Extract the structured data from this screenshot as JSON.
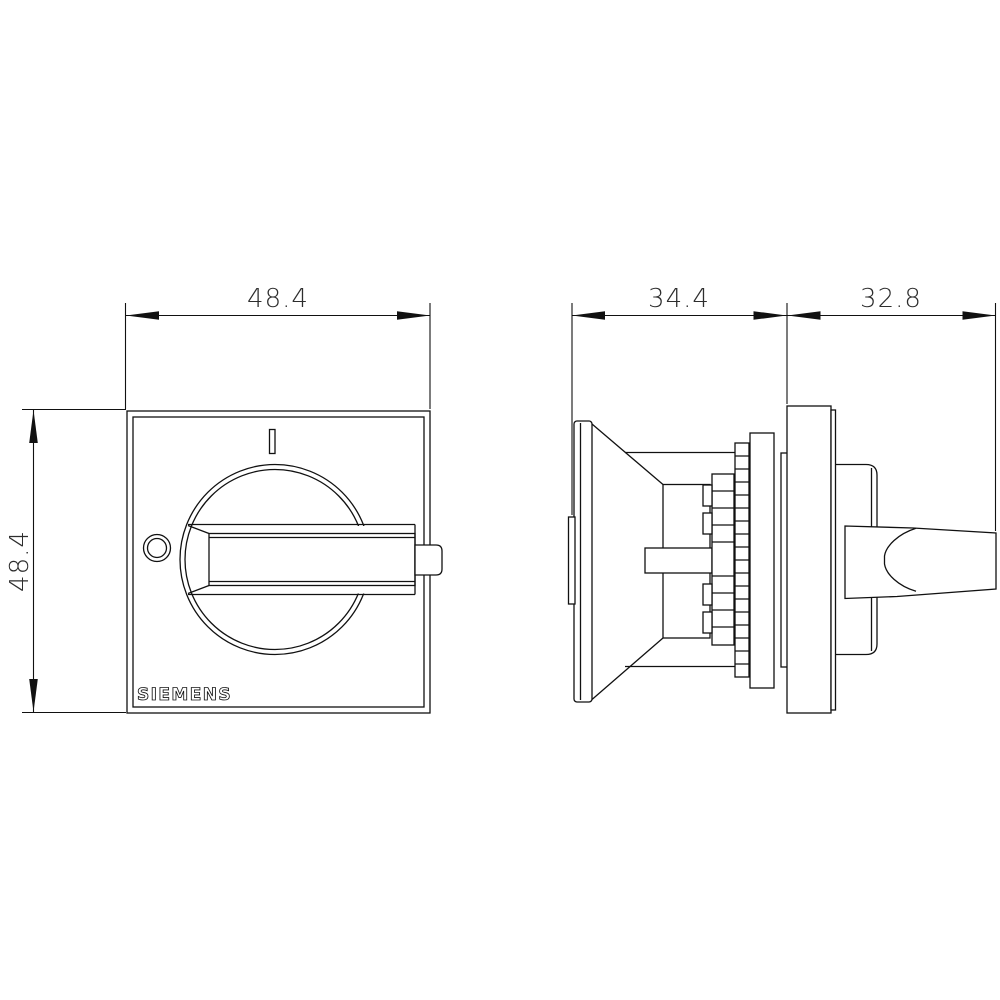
{
  "drawing": {
    "brand": "SIEMENS",
    "position_indicator": "I",
    "dimensions": {
      "front_width": "48.4",
      "front_height": "48.4",
      "handle_depth": "34.4",
      "body_depth": "32.8"
    }
  },
  "colors": {
    "background": "#ffffff",
    "line": "#111111",
    "dim_text": "#2d2d2d"
  }
}
